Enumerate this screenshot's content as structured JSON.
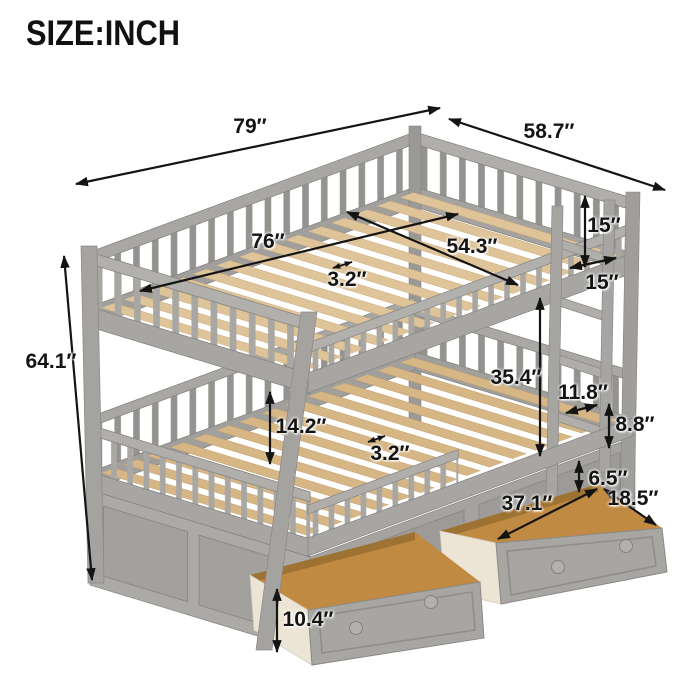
{
  "title": "SIZE:INCH",
  "illustration": "gray full-over-full bunk bed with ladder and two under-bed storage drawers",
  "colors": {
    "frame": "#a8a6a3",
    "slats_top": "#dfc499",
    "slats_bottom": "#d6b685",
    "drawer_interior": "#c18a42",
    "drawer_side": "#ece5d6",
    "annotation": "#141414",
    "background": "#ffffff"
  },
  "dimensions": {
    "overall_length": "79″",
    "overall_width": "58.7″",
    "overall_height": "64.1″",
    "top_slat_length": "76″",
    "top_slat_width": "54.3″",
    "top_slat_gap": "3.2″",
    "top_rail_height": "15″",
    "top_end_rail_height": "15″",
    "bunk_clearance": "35.4″",
    "ladder_width": "11.8″",
    "ladder_rung_spacing": "8.8″",
    "guardrail_height": "14.2″",
    "bottom_slat_gap": "3.2″",
    "drawer_clearance": "6.5″",
    "drawer_length": "37.1″",
    "drawer_depth": "18.5″",
    "drawer_height": "10.4″"
  }
}
